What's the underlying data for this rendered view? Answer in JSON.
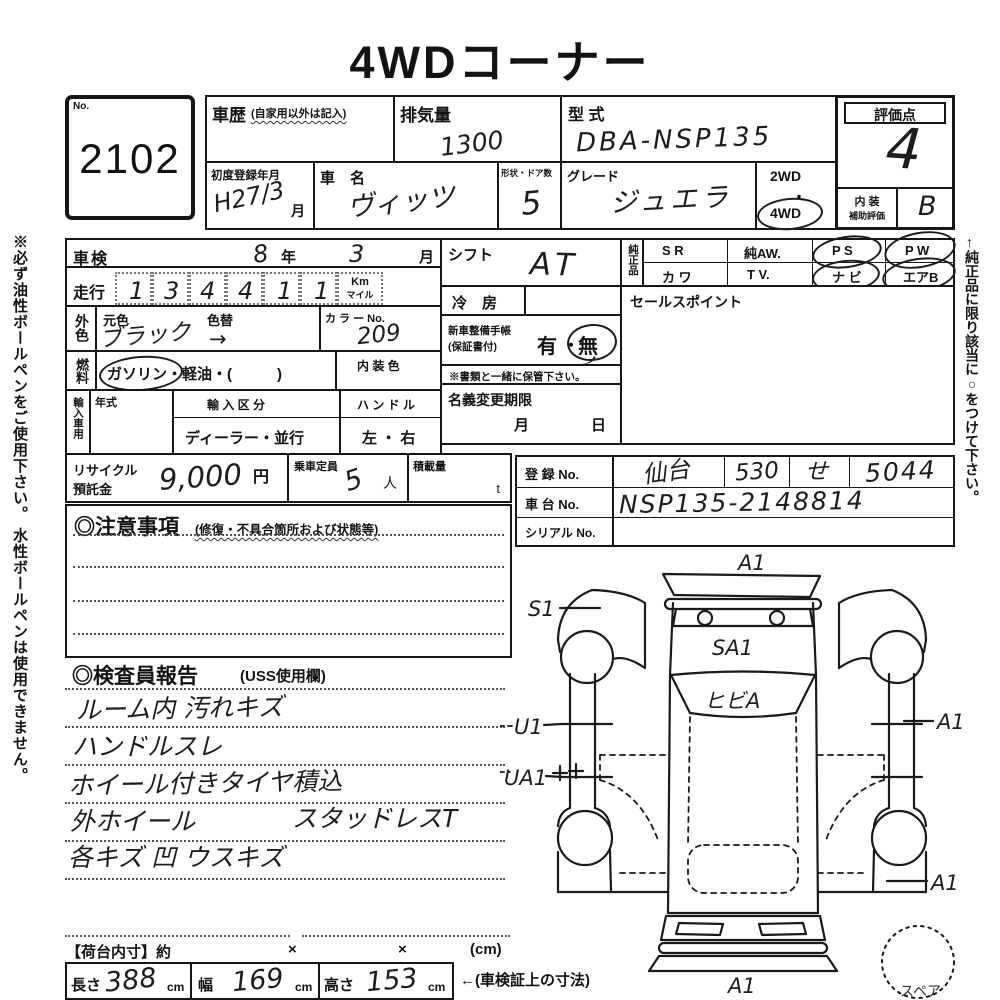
{
  "title": "4WDコーナー",
  "side_notes": {
    "left": "※必ず油性ボールペンをご使用下さい。 水性ボールペンは使用できません。",
    "right": "←純正品に限り該当に○をつけて下さい。"
  },
  "lot": {
    "label": "No.",
    "number": "2102"
  },
  "header": {
    "history": {
      "label": "車歴",
      "note": "(自家用以外は記入)"
    },
    "displacement": {
      "label": "排気量",
      "value": "1300"
    },
    "model_code": {
      "label": "型 式",
      "value": "DBA-NSP135"
    },
    "score": {
      "label": "評価点",
      "value": "4",
      "interior_label_1": "内 装",
      "interior_label_2": "補助評価",
      "interior_value": "B"
    },
    "first_reg": {
      "label": "初度登録年月",
      "value": "H27/3",
      "suffix": "月"
    },
    "car_name": {
      "label": "車　名",
      "value": "ヴィッツ"
    },
    "doors": {
      "label": "形状・ドア数",
      "value": "5"
    },
    "grade": {
      "label": "グレード",
      "value": "ジュエラ",
      "drive_top": "2WD",
      "drive_dot": "・",
      "drive_bottom": "4WD"
    }
  },
  "left_panel": {
    "shaken": {
      "label": "車検",
      "year": "8",
      "year_unit": "年",
      "month": "3",
      "month_unit": "月"
    },
    "mileage": {
      "label": "走行",
      "d1": "1",
      "d2": "3",
      "d3": "4",
      "d4": "4",
      "d5": "1",
      "d6": "1",
      "comma": ",",
      "unit_top": "Km",
      "unit_bottom": "マイル"
    },
    "color": {
      "side_label": "外色",
      "base_label": "元色",
      "change_label": "色替",
      "value": "ブラック",
      "arrow": "→",
      "no_label": "カ ラ ー No.",
      "no_value": "209"
    },
    "fuel": {
      "side_label": "燃料",
      "options": "ガソリン・軽油・(　　　)",
      "interior_label": "内 装 色"
    },
    "import": {
      "side_label": "輸入車用",
      "year_label": "年式",
      "division_label": "輸 入 区 分",
      "division_value": "ディーラー・並行",
      "handle_label": "ハ ン ド ル",
      "handle_value": "左 ・ 右"
    },
    "recycle": {
      "label1": "リサイクル",
      "label2": "預託金",
      "value": "9,000",
      "unit": "円",
      "cap_label": "乗車定員",
      "cap_value": "5",
      "cap_unit": "人",
      "load_label": "積載量",
      "load_unit": "t"
    }
  },
  "notes_box": {
    "title": "◎注意事項",
    "subtitle": "(修復・不具合箇所および状態等)"
  },
  "inspector": {
    "title": "◎検査員報告",
    "subtitle": "(USS使用欄)",
    "line1": "ルーム内 汚れキズ",
    "line2": "ハンドルスレ",
    "line3": "ホイール付きタイヤ積込",
    "line4a": "外ホイール",
    "line4b": "スタッドレスT",
    "line5": "各キズ 凹 ウスキズ"
  },
  "right_panel": {
    "shift": {
      "label": "シフト",
      "value": "AT"
    },
    "ac": {
      "label": "冷　房"
    },
    "book": {
      "label1": "新車整備手帳",
      "label2": "(保証書付)",
      "yes": "有",
      "dot": "・",
      "no": "無"
    },
    "keep_note": "※書類と一緒に保管下さい。",
    "transfer": {
      "label": "名義変更期限",
      "month": "月",
      "day": "日"
    },
    "genuine": {
      "side_label": "純正品",
      "r1c1": "S R",
      "r1c2": "純AW.",
      "r1c3": "P S",
      "r1c4": "P W",
      "r2c1": "カ ワ",
      "r2c2": "T V.",
      "r2c3": "ナ ビ",
      "r2c4": "エアB"
    },
    "sales": {
      "label": "セールスポイント"
    }
  },
  "registration": {
    "reg_label": "登 録 No.",
    "area": "仙台",
    "class_no": "530",
    "kana": "せ",
    "number": "5044",
    "chassis_label": "車 台 No.",
    "chassis": "NSP135-2148814",
    "serial_label": "シリアル No."
  },
  "diagram": {
    "mark_top": "A1",
    "mark_fender": "S1",
    "mark_hood": "SA1",
    "mark_windshield": "ヒビA",
    "mark_door_front": "U1",
    "mark_door_rear": "UA1",
    "mark_right_side": "A1",
    "mark_right_rear": "A1",
    "mark_bottom": "A1",
    "spare": "スペア"
  },
  "footer": {
    "label": "【荷台内寸】約",
    "x1": "×",
    "x2": "×",
    "unit": "(cm)",
    "len_label": "長さ",
    "len": "388",
    "len_unit": "cm",
    "wid_label": "幅",
    "wid": "169",
    "wid_unit": "cm",
    "hgt_label": "高さ",
    "hgt": "153",
    "hgt_unit": "cm",
    "note": "←(車検証上の寸法)"
  }
}
